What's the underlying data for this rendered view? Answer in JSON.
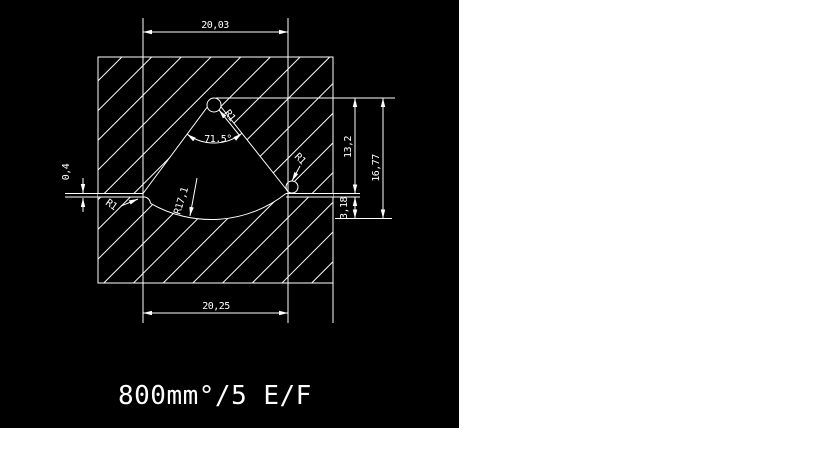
{
  "colors": {
    "viewport_background": "#000000",
    "line_color": "#ffffff",
    "page_background": "#ffffff"
  },
  "drawing": {
    "dimensions": {
      "top_width": "20,03",
      "bottom_width": "20,25",
      "right_height_upper": "13,2",
      "right_height_total": "16,77",
      "right_height_lower": "3,18",
      "left_slot_width": "0,4",
      "sector_angle": "71.5°",
      "sector_radius": "R17,1",
      "apex_fillet_radius": "R1",
      "right_corner_radius": "R1",
      "left_corner_radius": "R1"
    },
    "caption": "800mm°/5 E/F"
  }
}
